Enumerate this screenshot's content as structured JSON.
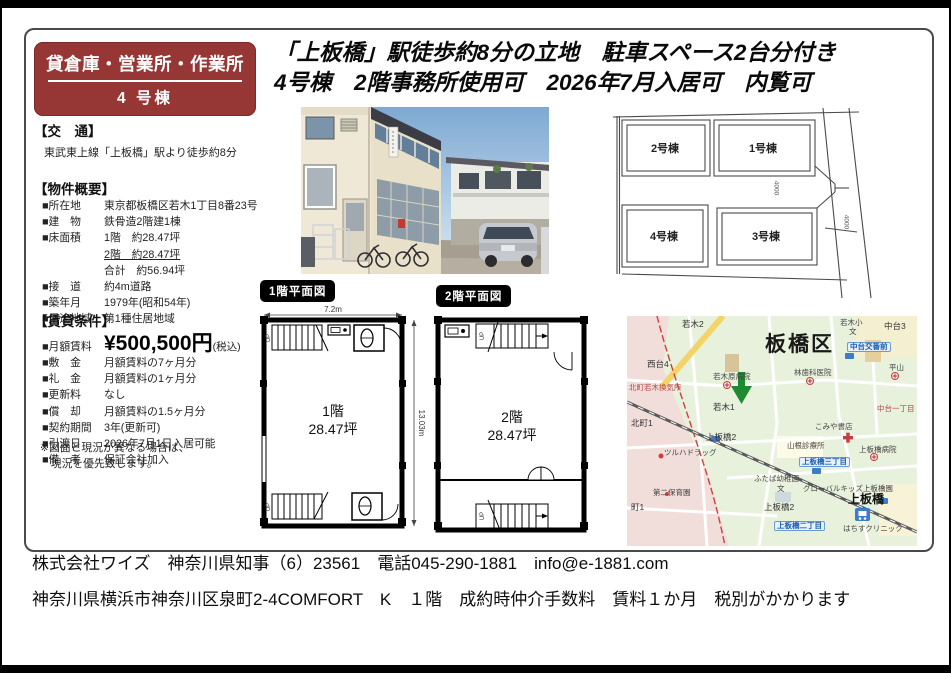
{
  "badge": {
    "line1": "貸倉庫・営業所・作業所",
    "line2": "4 号棟"
  },
  "headline": {
    "line1": "「上板橋」駅徒歩約8分の立地　駐車スペース2台分付き",
    "line2": "4号棟　2階事務所使用可　2026年7月入居可　内覧可"
  },
  "access": {
    "header": "【交　通】",
    "text": "東武東上線「上板橋」駅より徒歩約8分"
  },
  "overview": {
    "header": "【物件概要】",
    "rows": [
      {
        "label": "■所在地",
        "value": "東京都板橋区若木1丁目8番23号"
      },
      {
        "label": "■建　物",
        "value": "鉄骨造2階建1棟"
      },
      {
        "label": "■床面積",
        "value": "1階　約28.47坪"
      },
      {
        "label": "",
        "value": "2階　約28.47坪",
        "u": true
      },
      {
        "label": "",
        "value": "合計　約56.94坪"
      },
      {
        "label": "■接　道",
        "value": "約4m道路"
      },
      {
        "label": "■築年月",
        "value": "1979年(昭和54年)"
      },
      {
        "label": "■用途地域",
        "value": "第1種住居地域"
      }
    ]
  },
  "terms": {
    "header": "【賃貸条件】",
    "rent_label": "■月額賃料",
    "rent_value": "¥500,500円",
    "rent_suffix": "(税込)",
    "rows": [
      {
        "label": "■敷　金",
        "value": "月額賃料の7ヶ月分"
      },
      {
        "label": "■礼　金",
        "value": "月額賃料の1ヶ月分"
      },
      {
        "label": "■更新料",
        "value": "なし"
      },
      {
        "label": "■償　却",
        "value": "月額賃料の1.5ヶ月分"
      },
      {
        "label": "■契約期間",
        "value": "3年(更新可)"
      },
      {
        "label": "■引渡日",
        "value": "2026年7月1日入居可能"
      },
      {
        "label": "■備　考",
        "value": "保証会社加入"
      }
    ],
    "note1": "※図面と現況が異なる場合は、",
    "note2": "　現況を優先致します。"
  },
  "floorplans": {
    "f1": {
      "tag": "1階平面図",
      "floor": "1階",
      "area": "28.47坪",
      "width_dim": "7.2m",
      "height_dim": "13.03m",
      "up1": "UP",
      "up2": "UP"
    },
    "f2": {
      "tag": "2階平面図",
      "floor": "2階",
      "area": "28.47坪",
      "up1": "UP",
      "up2": "UP"
    }
  },
  "siteplan": {
    "labels": [
      {
        "t": "2号棟",
        "x": 56,
        "y": 40,
        "cls": "bld"
      },
      {
        "t": "1号棟",
        "x": 154,
        "y": 40,
        "cls": "bld"
      },
      {
        "t": "4号棟",
        "x": 55,
        "y": 128,
        "cls": "bld"
      },
      {
        "t": "3号棟",
        "x": 157,
        "y": 128,
        "cls": "bld"
      },
      {
        "t": "4000",
        "x": 167,
        "y": 80,
        "cls": "dim"
      },
      {
        "t": "4000",
        "x": 237,
        "y": 114,
        "cls": "dim"
      }
    ]
  },
  "map": {
    "labels": [
      {
        "t": "若木2",
        "x": 55,
        "y": 4
      },
      {
        "t": "板橋区",
        "x": 138,
        "y": 18,
        "cls": "big"
      },
      {
        "t": "若木小",
        "x": 213,
        "y": 3,
        "cls": "sm"
      },
      {
        "t": "文",
        "x": 222,
        "y": 12,
        "cls": "sm"
      },
      {
        "t": "中台3",
        "x": 257,
        "y": 6
      },
      {
        "t": "中台交番前",
        "x": 220,
        "y": 26,
        "cls": "bluebadge"
      },
      {
        "t": "西台4",
        "x": 20,
        "y": 44
      },
      {
        "t": "平山",
        "x": 262,
        "y": 48,
        "cls": "sm"
      },
      {
        "t": "若木原病院",
        "x": 86,
        "y": 57,
        "cls": "sm"
      },
      {
        "t": "林歯科医院",
        "x": 167,
        "y": 53,
        "cls": "sm"
      },
      {
        "t": "北町若木換気所",
        "x": 2,
        "y": 68,
        "cls": "red sm"
      },
      {
        "t": "若木1",
        "x": 86,
        "y": 87
      },
      {
        "t": "北町1",
        "x": 4,
        "y": 103
      },
      {
        "t": "上板橋2",
        "x": 79,
        "y": 117
      },
      {
        "t": "こみや書店",
        "x": 188,
        "y": 107,
        "cls": "sm"
      },
      {
        "t": "ツルハドラッグ",
        "x": 37,
        "y": 133,
        "cls": "sm"
      },
      {
        "t": "山根診療所",
        "x": 160,
        "y": 126,
        "cls": "sm"
      },
      {
        "t": "上板橋病院",
        "x": 232,
        "y": 130,
        "cls": "sm"
      },
      {
        "t": "上板橋三丁目",
        "x": 172,
        "y": 141,
        "cls": "bluebadge"
      },
      {
        "t": "ふたば幼稚園",
        "x": 127,
        "y": 159,
        "cls": "sm"
      },
      {
        "t": "文",
        "x": 150,
        "y": 169,
        "cls": "sm"
      },
      {
        "t": "グローバルキッズ上板橋園",
        "x": 176,
        "y": 169,
        "cls": "sm"
      },
      {
        "t": "第二保育園",
        "x": 26,
        "y": 173,
        "cls": "sm"
      },
      {
        "t": "町1",
        "x": 4,
        "y": 187
      },
      {
        "t": "上板橋2",
        "x": 137,
        "y": 187
      },
      {
        "t": "上板橋",
        "x": 221,
        "y": 177,
        "cls": "station"
      },
      {
        "t": "上板橋二丁目",
        "x": 147,
        "y": 205,
        "cls": "bluebadge"
      },
      {
        "t": "はちすクリニック",
        "x": 216,
        "y": 209,
        "cls": "sm"
      },
      {
        "t": "中台一丁目",
        "x": 250,
        "y": 89,
        "cls": "red sm"
      }
    ]
  },
  "footer": {
    "line1": "株式会社ワイズ　神奈川県知事（6）23561　電話045-290-1881　info@e-1881.com",
    "line2": "神奈川県横浜市神奈川区泉町2-4COMFORT　K　１階　成約時仲介手数料　賃料１か月　税別がかかります"
  }
}
